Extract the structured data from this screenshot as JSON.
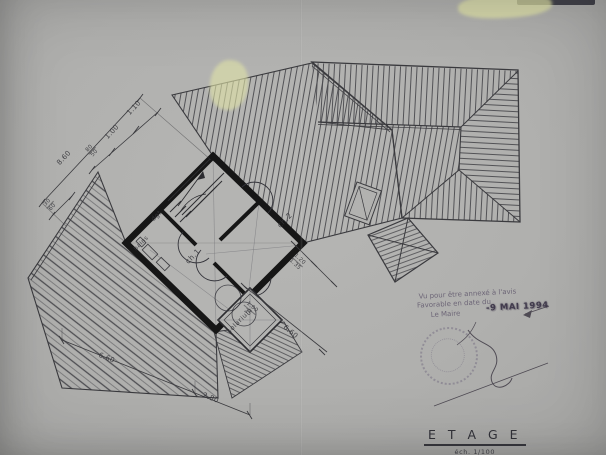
{
  "title_block": {
    "title": "E T A G E",
    "scale": "éch. 1/100"
  },
  "rooms": {
    "dgt": "dgt",
    "bains": "bains",
    "ch1": "ch.1",
    "ch2": "ch.2",
    "solarium": "solarium"
  },
  "dimensions": {
    "left": {
      "d1": "1.10",
      "d2": "1.00",
      "d3a": "80",
      "d3b": "50",
      "total": "8.60",
      "d4a": "30",
      "d4b": "60"
    },
    "right": {
      "d5a": "1.20",
      "d5b": "1.35",
      "d6a": "1.00",
      "d6b": "25",
      "d7": "6.60"
    },
    "bottom": {
      "d8": "6.60",
      "d9": "2.80"
    }
  },
  "stamp": {
    "line1": "Vu pour être annexé à l'avis",
    "line2": "Favorable en date du",
    "line3": "Le Maire",
    "date": "-9 MAI 1994"
  },
  "colors": {
    "paper": "#b0b0ae",
    "ink": "#3a3a3e",
    "wall": "#161616",
    "stamp_ink": "#675f72",
    "highlight": "#dfe2a8"
  }
}
